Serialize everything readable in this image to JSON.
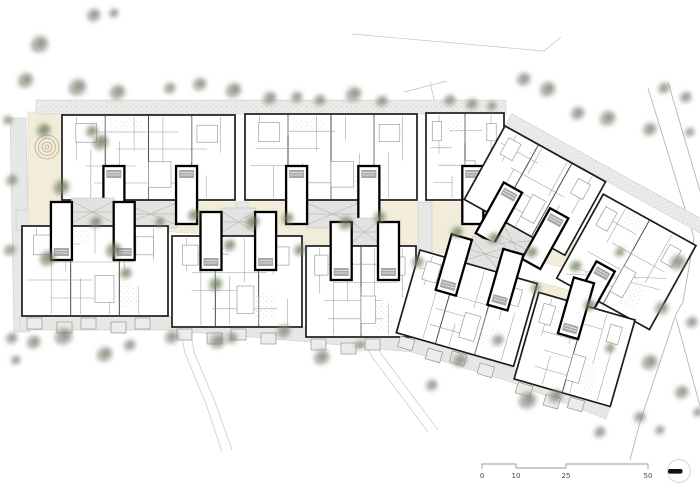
{
  "drawing": {
    "type": "architectural-site-plan",
    "description": "Ground floor site plan of a residential estate: two rows of apartment blocks with stair cores, beige courtyards with trees, playground at top left, street at right, scale bar bottom right"
  },
  "palette": {
    "paper": "#ffffff",
    "building_fill": "#ffffff",
    "building_outline": "#1c1c1c",
    "unit_wall": "#4a4a4a",
    "partition": "#9c9c9c",
    "core_outline": "#000000",
    "terrace_fill": "#ebebe9",
    "terrace_dot": "#bfbfbd",
    "path_fill": "#e7e7e5",
    "path_edge": "#c6c6c4",
    "courtyard_fill": "#f2ecda",
    "courtyard_edge": "#e2dac2",
    "tree_gray": "#8f9484",
    "tree_gray_dark": "#6f7565",
    "tree_green": "#7d8a6b",
    "tree_green_dark": "#5f6e4f",
    "road_line": "#b5b5b3",
    "walk_line": "#cccccb",
    "balcony_fill": "#ececea",
    "scale_text": "#4a4a4a"
  },
  "scale_bar": {
    "labels": [
      "0",
      "10",
      "25",
      "50"
    ],
    "tick_x": [
      482,
      516,
      566,
      648
    ],
    "bar_y": 464,
    "dip": 4,
    "label_y": 478
  },
  "north_marker": {
    "cx": 679,
    "cy": 471,
    "r": 11.5,
    "bar_x": 668,
    "bar_y": 469,
    "bar_w": 14.5,
    "bar_h": 4.6
  },
  "site": {
    "terrace_band": [
      36,
      100,
      470,
      14
    ],
    "left_road": [
      [
        10,
        118
      ],
      [
        26,
        118
      ],
      [
        30,
        332
      ],
      [
        14,
        332
      ]
    ],
    "left_path": [
      16,
      210,
      72,
      20
    ],
    "courtyard_polygon": [
      [
        86,
        202
      ],
      [
        505,
        202
      ],
      [
        548,
        222
      ],
      [
        596,
        248
      ],
      [
        584,
        272
      ],
      [
        540,
        262
      ],
      [
        470,
        256
      ],
      [
        418,
        250
      ],
      [
        306,
        244
      ],
      [
        204,
        234
      ],
      [
        86,
        226
      ]
    ],
    "courtyard_patches": [
      [
        533,
        280,
        60,
        18,
        16
      ],
      [
        356,
        303,
        32,
        26,
        0
      ]
    ],
    "mid_connectors": [
      [
        236,
        202,
        12,
        42
      ],
      [
        418,
        202,
        14,
        52
      ],
      [
        88,
        202,
        22,
        26
      ],
      [
        500,
        202,
        18,
        56
      ]
    ],
    "arcade_polygon": [
      [
        20,
        316
      ],
      [
        168,
        316
      ],
      [
        300,
        327
      ],
      [
        416,
        338
      ],
      [
        513,
        368
      ],
      [
        610,
        407
      ],
      [
        606,
        419
      ],
      [
        508,
        381
      ],
      [
        412,
        352
      ],
      [
        298,
        341
      ],
      [
        166,
        330
      ],
      [
        20,
        330
      ]
    ],
    "playground": {
      "rect": [
        28,
        112,
        140,
        116
      ],
      "spiral": {
        "cx": 47,
        "cy": 147,
        "radii": [
          12,
          8.5,
          5,
          2
        ]
      },
      "circle": [
        77,
        191,
        5.5
      ],
      "icons": [
        [
          92,
          123,
          8,
          6
        ],
        [
          103,
          122,
          6,
          9
        ]
      ]
    },
    "road_lines": [
      [
        [
          648,
          88
        ],
        [
          694,
          238
        ],
        [
          683,
          302
        ],
        [
          676,
          314
        ],
        [
          640,
          422
        ],
        [
          630,
          460
        ]
      ],
      [
        [
          668,
          82
        ],
        [
          712,
          232
        ]
      ],
      [
        [
          676,
          318
        ],
        [
          706,
          428
        ]
      ]
    ],
    "thin_lines": [
      [
        [
          352,
          34
        ],
        [
          544,
          51
        ],
        [
          561,
          37
        ]
      ],
      [
        [
          404,
          92
        ],
        [
          447,
          81
        ]
      ],
      [
        [
          430,
          82
        ],
        [
          436,
          108
        ]
      ]
    ],
    "walk_lines": [
      [
        [
          188,
          318
        ],
        [
          194,
          352
        ],
        [
          215,
          402
        ],
        [
          232,
          450
        ]
      ],
      [
        [
          178,
          319
        ],
        [
          185,
          353
        ],
        [
          206,
          404
        ],
        [
          222,
          452
        ]
      ],
      [
        [
          358,
          331
        ],
        [
          372,
          357
        ],
        [
          428,
          432
        ]
      ],
      [
        [
          368,
          329
        ],
        [
          382,
          355
        ],
        [
          438,
          430
        ]
      ]
    ]
  },
  "buildings": {
    "straight": [
      {
        "x": 62,
        "y": 115,
        "w": 173,
        "h": 85,
        "cores": [
          0.3,
          0.72
        ],
        "dir": 1
      },
      {
        "x": 245,
        "y": 114,
        "w": 172,
        "h": 86,
        "cores": [
          0.3,
          0.72
        ],
        "dir": 1
      },
      {
        "x": 426,
        "y": 113,
        "w": 78,
        "h": 87,
        "cores": [
          0.6
        ],
        "dir": 1
      },
      {
        "x": 22,
        "y": 226,
        "w": 146,
        "h": 90,
        "cores": [
          0.27,
          0.7
        ],
        "dir": -1
      },
      {
        "x": 172,
        "y": 236,
        "w": 130,
        "h": 91,
        "cores": [
          0.3,
          0.72
        ],
        "dir": -1
      },
      {
        "x": 306,
        "y": 246,
        "w": 110,
        "h": 91,
        "cores": [
          0.32,
          0.75
        ],
        "dir": -1
      }
    ],
    "rotated_groups": [
      {
        "tx": 505,
        "ty": 126,
        "rot": 29,
        "terrace": [
          0,
          -14,
          226,
          13
        ],
        "blocks": [
          {
            "x": 0,
            "y": 0,
            "w": 115,
            "h": 84,
            "cores": [
              0.32,
              0.78
            ],
            "dir": 1
          },
          {
            "x": 119,
            "y": 12,
            "w": 106,
            "h": 96,
            "cores": [
              0.35
            ],
            "dir": 1,
            "open": true
          }
        ]
      },
      {
        "tx": 420,
        "ty": 250,
        "rot": 16,
        "blocks": [
          {
            "x": 0,
            "y": 0,
            "w": 122,
            "h": 86,
            "cores": [
              0.3,
              0.74
            ],
            "dir": -1
          },
          {
            "x": 126,
            "y": 8,
            "w": 100,
            "h": 90,
            "cores": [
              0.4
            ],
            "dir": -1
          }
        ]
      }
    ]
  },
  "trees": {
    "gray": [
      [
        94,
        15,
        7
      ],
      [
        114,
        13,
        5
      ],
      [
        40,
        44,
        9
      ],
      [
        26,
        80,
        8
      ],
      [
        78,
        87,
        9
      ],
      [
        118,
        92,
        8
      ],
      [
        170,
        88,
        6
      ],
      [
        200,
        84,
        7
      ],
      [
        234,
        90,
        8
      ],
      [
        270,
        98,
        7
      ],
      [
        297,
        97,
        6
      ],
      [
        320,
        100,
        6
      ],
      [
        354,
        94,
        8
      ],
      [
        382,
        101,
        6
      ],
      [
        450,
        100,
        6
      ],
      [
        472,
        104,
        6
      ],
      [
        492,
        106,
        5
      ],
      [
        524,
        79,
        7
      ],
      [
        548,
        89,
        8
      ],
      [
        578,
        113,
        7
      ],
      [
        608,
        118,
        8
      ],
      [
        650,
        129,
        7
      ],
      [
        664,
        88,
        6
      ],
      [
        686,
        97,
        6
      ],
      [
        690,
        132,
        5
      ],
      [
        678,
        262,
        8
      ],
      [
        662,
        308,
        7
      ],
      [
        692,
        322,
        6
      ],
      [
        650,
        362,
        8
      ],
      [
        682,
        392,
        7
      ],
      [
        640,
        417,
        6
      ],
      [
        698,
        412,
        5
      ],
      [
        12,
        338,
        6
      ],
      [
        34,
        342,
        7
      ],
      [
        64,
        336,
        9
      ],
      [
        105,
        354,
        8
      ],
      [
        130,
        345,
        6
      ],
      [
        172,
        337,
        7
      ],
      [
        218,
        341,
        8
      ],
      [
        232,
        338,
        6
      ],
      [
        284,
        331,
        7
      ],
      [
        322,
        357,
        8
      ],
      [
        360,
        345,
        5
      ],
      [
        432,
        385,
        6
      ],
      [
        460,
        360,
        7
      ],
      [
        498,
        340,
        6
      ],
      [
        528,
        400,
        9
      ],
      [
        556,
        396,
        7
      ],
      [
        600,
        432,
        6
      ],
      [
        660,
        430,
        5
      ],
      [
        16,
        360,
        5
      ],
      [
        8,
        120,
        5
      ],
      [
        12,
        180,
        6
      ],
      [
        10,
        250,
        6
      ]
    ],
    "green": [
      [
        44,
        130,
        7
      ],
      [
        101,
        142,
        8
      ],
      [
        62,
        187,
        8
      ],
      [
        48,
        258,
        8
      ],
      [
        114,
        250,
        8
      ],
      [
        126,
        273,
        6
      ],
      [
        216,
        284,
        7
      ],
      [
        194,
        215,
        6
      ],
      [
        253,
        222,
        7
      ],
      [
        288,
        218,
        6
      ],
      [
        346,
        223,
        7
      ],
      [
        380,
        217,
        6
      ],
      [
        300,
        250,
        6
      ],
      [
        230,
        245,
        6
      ],
      [
        418,
        262,
        6
      ],
      [
        457,
        232,
        6
      ],
      [
        494,
        238,
        6
      ],
      [
        532,
        252,
        6
      ],
      [
        576,
        266,
        6
      ],
      [
        590,
        305,
        6
      ],
      [
        610,
        348,
        5
      ],
      [
        536,
        288,
        5
      ],
      [
        96,
        222,
        6
      ],
      [
        160,
        222,
        5
      ],
      [
        620,
        252,
        5
      ],
      [
        92,
        131,
        6
      ]
    ]
  }
}
